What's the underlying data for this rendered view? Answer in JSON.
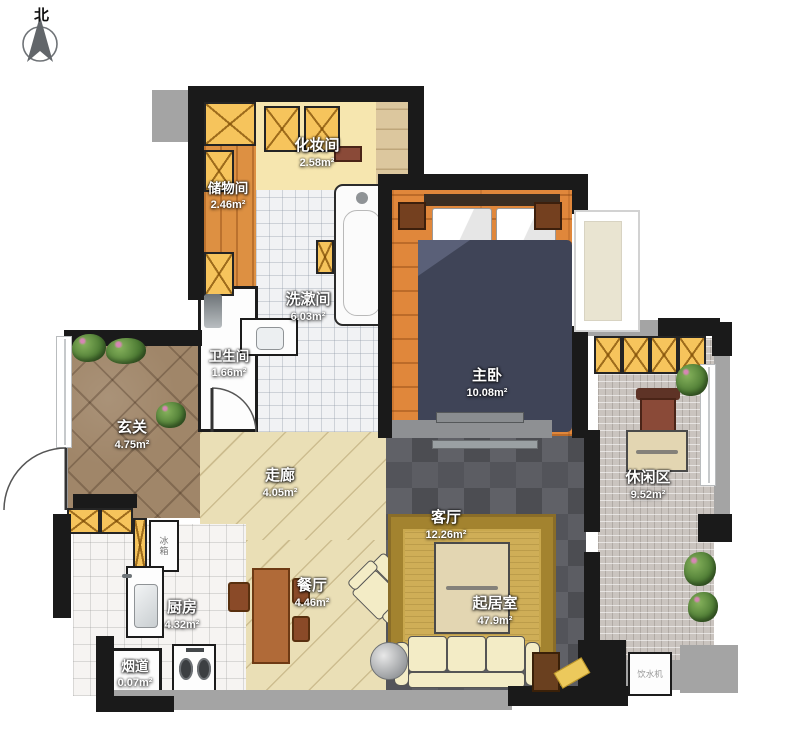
{
  "compass": {
    "label": "北"
  },
  "rooms": {
    "makeup_room": {
      "name": "化妆间",
      "area": "2.58m²"
    },
    "storage_room": {
      "name": "储物间",
      "area": "2.46m²"
    },
    "washroom": {
      "name": "洗漱间",
      "area": "6.03m²"
    },
    "toilet": {
      "name": "卫生间",
      "area": "1.66m²"
    },
    "master_bedroom": {
      "name": "主卧",
      "area": "10.08m²"
    },
    "entry": {
      "name": "玄关",
      "area": "4.75m²"
    },
    "corridor": {
      "name": "走廊",
      "area": "4.05m²"
    },
    "living_room": {
      "name": "客厅",
      "area": "12.26m²"
    },
    "leisure_area": {
      "name": "休闲区",
      "area": "9.52m²"
    },
    "kitchen": {
      "name": "厨房",
      "area": "4.32m²"
    },
    "dining_room": {
      "name": "餐厅",
      "area": "4.46m²"
    },
    "sitting_room": {
      "name": "起居室",
      "area": "47.9m²"
    },
    "flue": {
      "name": "烟道",
      "area": "0.07m²"
    }
  },
  "appliances": {
    "fridge_label": "冰箱",
    "water_dispenser_label": "饮水机"
  },
  "palette": {
    "wall": "#1a1a1a",
    "concrete": "#a4a4a4",
    "wood-floor": "#e0873b",
    "slate": "#55565b",
    "rug-gold": "#c9a855",
    "cabinet-yellow": "#f6c45c",
    "plank-light": "#eadfb6",
    "entry-tile": "#a08669",
    "mosaic": "#cac4bf",
    "bed-navy": "#3f4457",
    "sofa-cream": "#f3ecc6"
  }
}
